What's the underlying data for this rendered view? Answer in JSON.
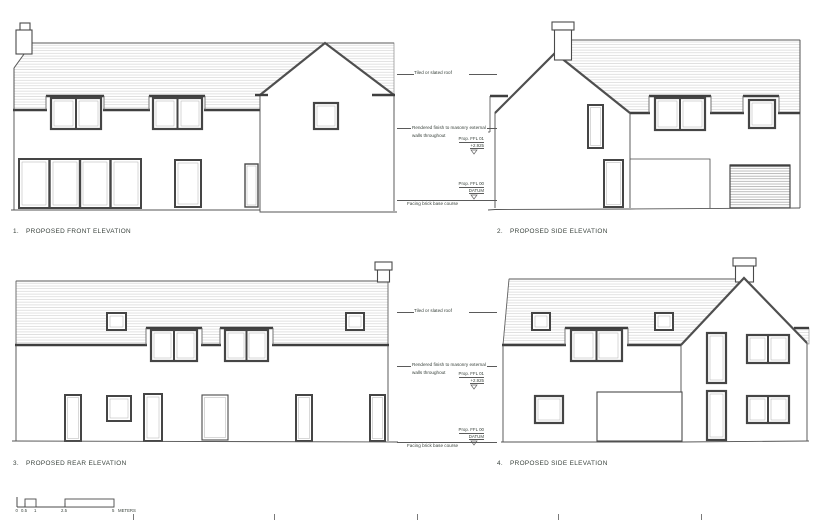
{
  "drawings": {
    "d1": {
      "number": "1.",
      "label": "PROPOSED FRONT ELEVATION"
    },
    "d2": {
      "number": "2.",
      "label": "PROPOSED SIDE ELEVATION"
    },
    "d3": {
      "number": "3.",
      "label": "PROPOSED REAR ELEVATION"
    },
    "d4": {
      "number": "4.",
      "label": "PROPOSED SIDE ELEVATION"
    }
  },
  "annotations": {
    "roof": "Tiled or slated roof",
    "walls_line1": "Rendered finish to masonry external",
    "walls_line2": "walls throughout",
    "ffl01_label": "Prop. FFL 01",
    "ffl01_value": "+2.925",
    "ffl00_label": "Prop. FFL 00",
    "ffl00_value": "DATUM",
    "base": "Facing brick base course"
  },
  "scale_bar": {
    "ticks": [
      "0",
      "0.5",
      "1",
      "2.5",
      "5"
    ],
    "unit": "METERS"
  },
  "colors": {
    "line": "#4a4a4a",
    "roof_hatch": "#d6d6d6",
    "text": "#39423c"
  }
}
